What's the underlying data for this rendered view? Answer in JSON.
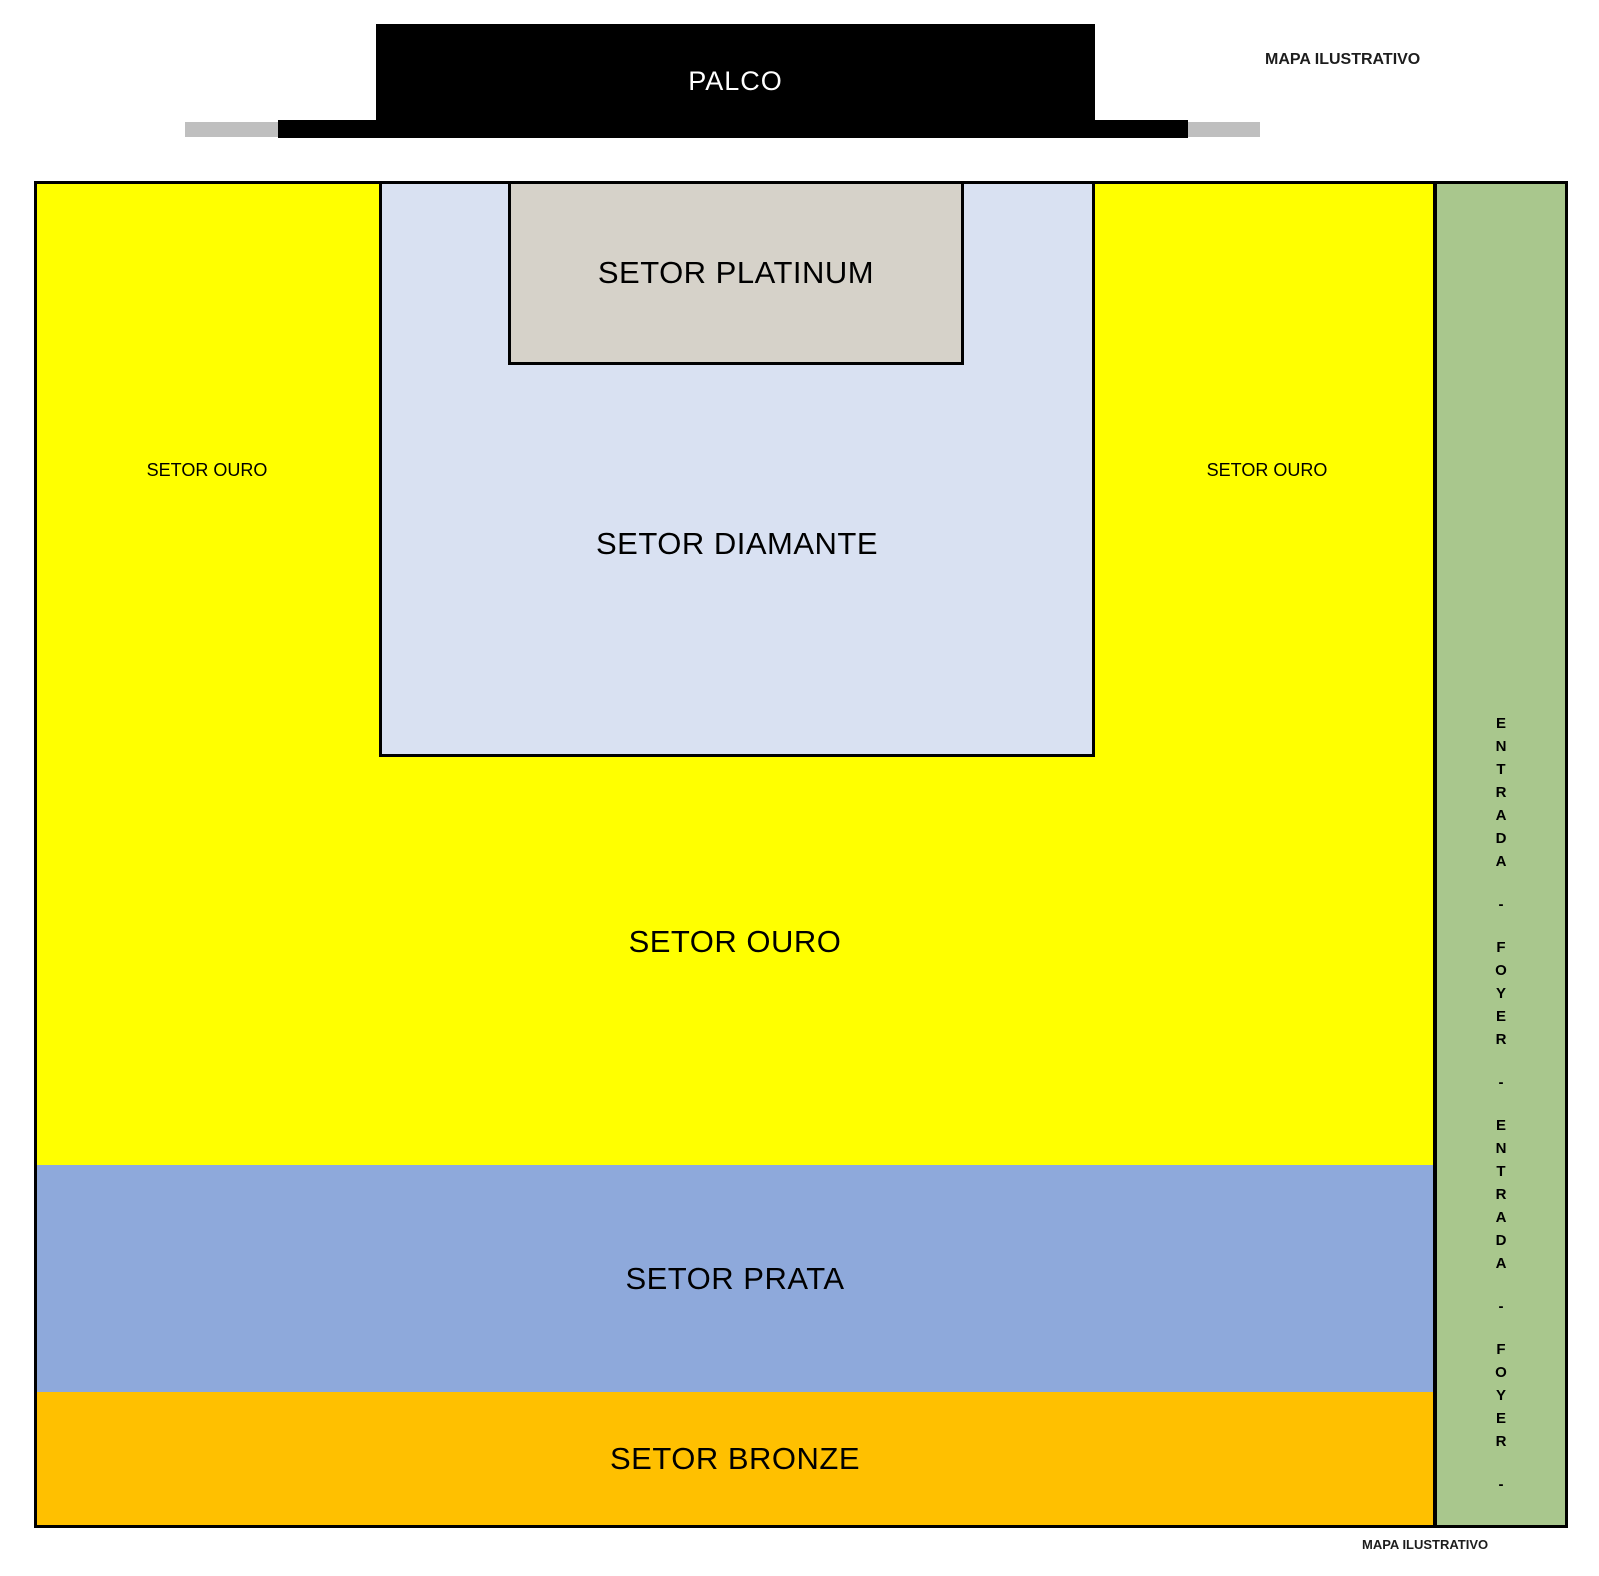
{
  "meta": {
    "watermark_top": "MAPA ILUSTRATIVO",
    "watermark_bottom": "MAPA ILUSTRATIVO"
  },
  "stage": {
    "label": "PALCO",
    "color": "#000000",
    "wing_color": "#bfbfbf"
  },
  "sectors": {
    "platinum": {
      "label": "SETOR PLATINUM",
      "color": "#d6d2c9"
    },
    "diamante": {
      "label": "SETOR DIAMANTE",
      "color": "#d9e1f2"
    },
    "ouro": {
      "label": "SETOR OURO",
      "side_label": "SETOR OURO",
      "color": "#ffff00"
    },
    "prata": {
      "label": "SETOR PRATA",
      "color": "#8ea9db"
    },
    "bronze": {
      "label": "SETOR BRONZE",
      "color": "#ffc000"
    }
  },
  "entrance": {
    "vertical_text": "ENTRADA-FOYER-ENTRADA-FOYER-",
    "label": "ENTRADA - FOYER - ENTRADA - FOYER -",
    "color": "#a9c78d"
  }
}
